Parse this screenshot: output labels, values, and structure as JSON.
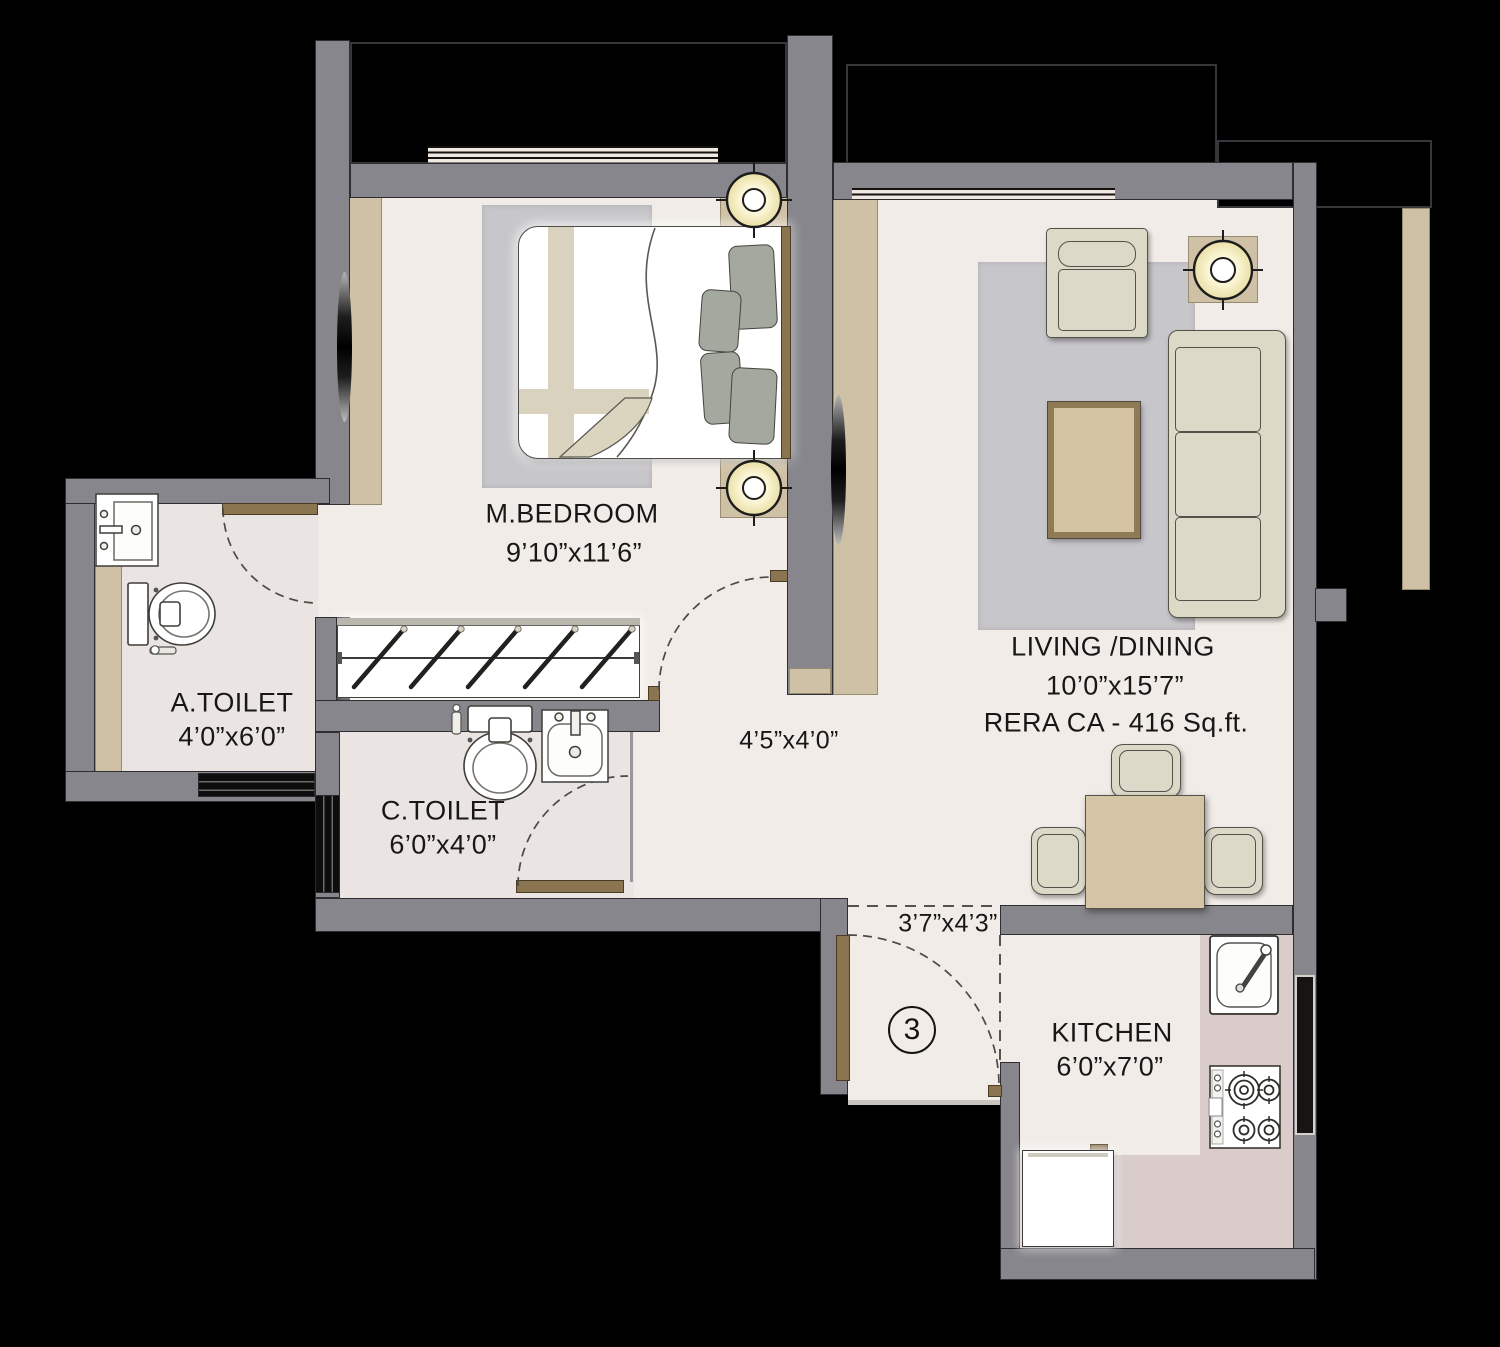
{
  "plan_title": "1 BHK Unit Floor Plan",
  "rooms": {
    "master_bedroom": {
      "name": "M.BEDROOM",
      "dims": "9’10”x11’6”"
    },
    "living_dining": {
      "name": "LIVING /DINING",
      "dims": "10’0”x15’7”",
      "rera": "RERA CA - 416 Sq.ft."
    },
    "attached_toilet": {
      "name": "A.TOILET",
      "dims": "4’0”x6’0”"
    },
    "common_toilet": {
      "name": "C.TOILET",
      "dims": "6’0”x4’0”"
    },
    "kitchen": {
      "name": "KITCHEN",
      "dims": "6’0”x7’0”"
    },
    "passage": {
      "dims": "4’5”x4’0”"
    },
    "foyer": {
      "dims": "3’7”x4’3”",
      "unit_number": "3"
    }
  },
  "colors": {
    "background": "#000000",
    "wall": "#87868c",
    "floor": "#f1ece7",
    "toilet_floor": "#eae5e2",
    "kitchen_counter": "#d9cccb",
    "accent_tan": "#cfc1a5",
    "door_leaf": "#8a7550",
    "rug": "#c7c6ca",
    "furniture": "#ddd9c7"
  }
}
